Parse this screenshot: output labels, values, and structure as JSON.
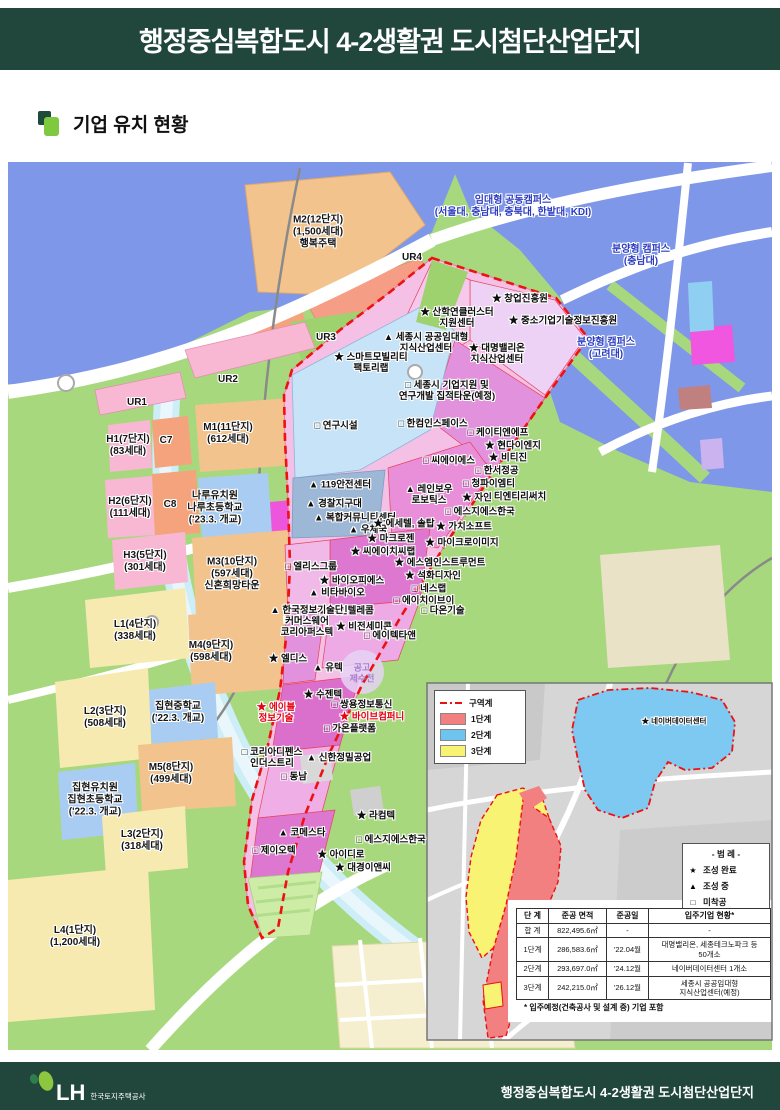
{
  "colors": {
    "header_green": "#21463b",
    "boundary_red": "#ee1111",
    "stage1": "#f28080",
    "stage2": "#6fc3ef",
    "stage3": "#f8f372"
  },
  "header": {
    "title": "행정중심복합도시 4-2생활권 도시첨단산업단지"
  },
  "section": {
    "title": "기업 유치 현황"
  },
  "map": {
    "area_labels": [
      {
        "t": "M2(12단지)\n(1,500세대)\n행복주택",
        "x": 318,
        "y": 232
      },
      {
        "t": "UR4",
        "x": 412,
        "y": 258
      },
      {
        "t": "UR3",
        "x": 326,
        "y": 338
      },
      {
        "t": "UR2",
        "x": 228,
        "y": 380
      },
      {
        "t": "UR1",
        "x": 137,
        "y": 403
      },
      {
        "t": "H1(7단지)\n(83세대)",
        "x": 128,
        "y": 446
      },
      {
        "t": "C7",
        "x": 166,
        "y": 441
      },
      {
        "t": "M1(11단지)\n(612세대)",
        "x": 228,
        "y": 434
      },
      {
        "t": "H2(6단지)\n(111세대)",
        "x": 130,
        "y": 508
      },
      {
        "t": "C8",
        "x": 170,
        "y": 505
      },
      {
        "t": "나루유치원\n나루초등학교\n('23.3. 개교)",
        "x": 215,
        "y": 508
      },
      {
        "t": "H3(5단지)\n(301세대)",
        "x": 145,
        "y": 562
      },
      {
        "t": "M3(10단지)\n(597세대)\n신혼희망타운",
        "x": 232,
        "y": 574
      },
      {
        "t": "L1(4단지)\n(338세대)",
        "x": 135,
        "y": 631
      },
      {
        "t": "M4(9단지)\n(598세대)",
        "x": 211,
        "y": 652
      },
      {
        "t": "집현중학교\n('22.3. 개교)",
        "x": 178,
        "y": 713
      },
      {
        "t": "L2(3단지)\n(508세대)",
        "x": 105,
        "y": 718
      },
      {
        "t": "M5(8단지)\n(499세대)",
        "x": 171,
        "y": 774
      },
      {
        "t": "집현유치원\n집현초등학교\n('22.3. 개교)",
        "x": 95,
        "y": 800
      },
      {
        "t": "L3(2단지)\n(318세대)",
        "x": 142,
        "y": 841
      },
      {
        "t": "L4(1단지)\n(1,200세대)",
        "x": 75,
        "y": 937
      }
    ],
    "campus_labels": [
      {
        "t": "임대형 공동캠퍼스\n(서울대, 충남대, 충북대, 한밭대, KDI)",
        "x": 513,
        "y": 207
      },
      {
        "t": "분양형 캠퍼스\n(충남대)",
        "x": 641,
        "y": 256
      },
      {
        "t": "분양형 캠퍼스\n(고려대)",
        "x": 606,
        "y": 349
      }
    ],
    "company_labels": [
      {
        "m": "★",
        "t": "창업진흥원",
        "x": 520,
        "y": 299
      },
      {
        "m": "★",
        "t": "산학연클러스터\n지원센터",
        "x": 457,
        "y": 318
      },
      {
        "m": "★",
        "t": "중소기업기술정보진흥원",
        "x": 563,
        "y": 321
      },
      {
        "m": "▲",
        "t": "세종시 공공임대형\n지식산업센터",
        "x": 426,
        "y": 343
      },
      {
        "m": "★",
        "t": "대명밸리온\n지식산업센터",
        "x": 497,
        "y": 354
      },
      {
        "m": "★",
        "t": "스마트모빌리티\n팩토리랩",
        "x": 371,
        "y": 363
      },
      {
        "m": "□",
        "t": "세종시 기업지원 및\n연구개발 집적타운(예정)",
        "x": 447,
        "y": 391
      },
      {
        "m": "□",
        "t": "연구시설",
        "x": 336,
        "y": 426
      },
      {
        "m": "□",
        "t": "한컴인스페이스",
        "x": 433,
        "y": 424
      },
      {
        "m": "□",
        "t": "케이티엔에프",
        "x": 498,
        "y": 433
      },
      {
        "m": "★",
        "t": "현다이엔지",
        "x": 513,
        "y": 446
      },
      {
        "m": "□",
        "t": "씨에이에스",
        "x": 449,
        "y": 461
      },
      {
        "m": "★",
        "t": "비티진",
        "x": 508,
        "y": 458
      },
      {
        "m": "□",
        "t": "한서정공",
        "x": 497,
        "y": 471
      },
      {
        "m": "□",
        "t": "청파이엠티",
        "x": 489,
        "y": 484
      },
      {
        "m": "★",
        "t": "티엔티리써치",
        "x": 514,
        "y": 497
      },
      {
        "m": "▲",
        "t": "119안전센터",
        "x": 340,
        "y": 485
      },
      {
        "m": "▲",
        "t": "경찰지구대",
        "x": 334,
        "y": 504
      },
      {
        "m": "▲",
        "t": "복합커뮤니티센터",
        "x": 355,
        "y": 518
      },
      {
        "m": "▲",
        "t": "우체국",
        "x": 368,
        "y": 530
      },
      {
        "m": "★",
        "t": "에세텔, 솔탑",
        "x": 404,
        "y": 524
      },
      {
        "m": "▲",
        "t": "레인보우\n로보틱스",
        "x": 429,
        "y": 495
      },
      {
        "m": "★",
        "t": "자인",
        "x": 477,
        "y": 498
      },
      {
        "m": "□",
        "t": "에스지에스한국",
        "x": 480,
        "y": 512
      },
      {
        "m": "★",
        "t": "가치소프트",
        "x": 464,
        "y": 527
      },
      {
        "m": "★",
        "t": "마크로젠",
        "x": 391,
        "y": 539
      },
      {
        "m": "★",
        "t": "마이크로이미지",
        "x": 462,
        "y": 543
      },
      {
        "m": "★",
        "t": "씨에이치씨랩",
        "x": 383,
        "y": 552
      },
      {
        "m": "★",
        "t": "에스엠인스트루먼트",
        "x": 440,
        "y": 563
      },
      {
        "m": "★",
        "t": "석화디자인",
        "x": 433,
        "y": 576
      },
      {
        "m": "□",
        "t": "네스랩",
        "x": 429,
        "y": 589
      },
      {
        "m": "□",
        "t": "에이치이브이",
        "x": 424,
        "y": 601
      },
      {
        "m": "□",
        "t": "다온기술",
        "x": 443,
        "y": 611
      },
      {
        "m": "□",
        "t": "엘리스그룹",
        "x": 311,
        "y": 567
      },
      {
        "m": "★",
        "t": "바이오피에스",
        "x": 352,
        "y": 581
      },
      {
        "m": "▲",
        "t": "비타바이오",
        "x": 337,
        "y": 593
      },
      {
        "m": "▲",
        "t": "싸인텔레콤",
        "x": 346,
        "y": 611
      },
      {
        "m": "▲",
        "t": "한국정보기술단\n커머스웨어\n코리아퍼스텍",
        "x": 307,
        "y": 622
      },
      {
        "m": "★",
        "t": "비전세미콘",
        "x": 364,
        "y": 627
      },
      {
        "m": "□",
        "t": "에이텍타앤",
        "x": 390,
        "y": 636
      },
      {
        "m": "★",
        "t": "엘디스",
        "x": 288,
        "y": 659
      },
      {
        "m": "▲",
        "t": "유텍",
        "x": 328,
        "y": 668
      },
      {
        "m": "★",
        "t": "수젠텍",
        "x": 323,
        "y": 695
      },
      {
        "m": "□",
        "t": "쌍용정보통신",
        "x": 362,
        "y": 705
      },
      {
        "m": "★",
        "t": "바이브컴퍼니",
        "x": 372,
        "y": 717,
        "c": "red"
      },
      {
        "m": "□",
        "t": "가온플랫폼",
        "x": 350,
        "y": 729
      },
      {
        "m": "★",
        "t": "에이블\n정보기술",
        "x": 276,
        "y": 713,
        "c": "red"
      },
      {
        "m": "▲",
        "t": "신한정밀공업",
        "x": 339,
        "y": 758
      },
      {
        "m": "□",
        "t": "동남",
        "x": 294,
        "y": 777
      },
      {
        "m": "□",
        "t": "코리아디펜스\n인더스트리",
        "x": 272,
        "y": 758
      },
      {
        "m": "▲",
        "t": "코메스타",
        "x": 302,
        "y": 833
      },
      {
        "m": "★",
        "t": "라컴텍",
        "x": 376,
        "y": 816
      },
      {
        "m": "□",
        "t": "제이오텍",
        "x": 274,
        "y": 851
      },
      {
        "m": "□",
        "t": "에스지에스한국",
        "x": 391,
        "y": 840
      },
      {
        "m": "★",
        "t": "아이디로",
        "x": 341,
        "y": 855
      },
      {
        "m": "★",
        "t": "대경이앤씨",
        "x": 363,
        "y": 868
      }
    ],
    "watermark": {
      "t": "공고\n제수전",
      "x": 362,
      "y": 673
    }
  },
  "inset": {
    "naver_label": {
      "m": "★",
      "t": "네이버데이터센터",
      "x": 674,
      "y": 722
    },
    "legend_zones": [
      {
        "label": "구역계",
        "type": "boundary"
      },
      {
        "label": "1단계",
        "color": "#f28080"
      },
      {
        "label": "2단계",
        "color": "#6fc3ef"
      },
      {
        "label": "3단계",
        "color": "#f8f372"
      }
    ],
    "marker_legend": {
      "title": "- 범 례 -",
      "items": [
        {
          "m": "★",
          "label": "조성 완료"
        },
        {
          "m": "▲",
          "label": "조성 중"
        },
        {
          "m": "□",
          "label": "미착공"
        }
      ]
    },
    "table": {
      "headers": [
        "단 계",
        "준공 면적",
        "준공일",
        "입주기업 현황*"
      ],
      "rows": [
        [
          "합 계",
          "822,495.6㎡",
          "-",
          "-"
        ],
        [
          "1단계",
          "286,583.6㎡",
          "'22.04월",
          "대명밸리온, 세종테크노파크 등\n50개소"
        ],
        [
          "2단계",
          "293,697.0㎡",
          "'24.12월",
          "네이버데이터센터 1개소"
        ],
        [
          "3단계",
          "242,215.0㎡",
          "'26.12월",
          "세종시 공공임대형\n지식산업센터(예정)"
        ]
      ],
      "footnote": "* 입주예정(건축공사 및 설계 중) 기업 포함"
    }
  },
  "footer": {
    "logo": "LH",
    "org": "한국토지주택공사",
    "title": "행정중심복합도시 4-2생활권 도시첨단산업단지"
  }
}
